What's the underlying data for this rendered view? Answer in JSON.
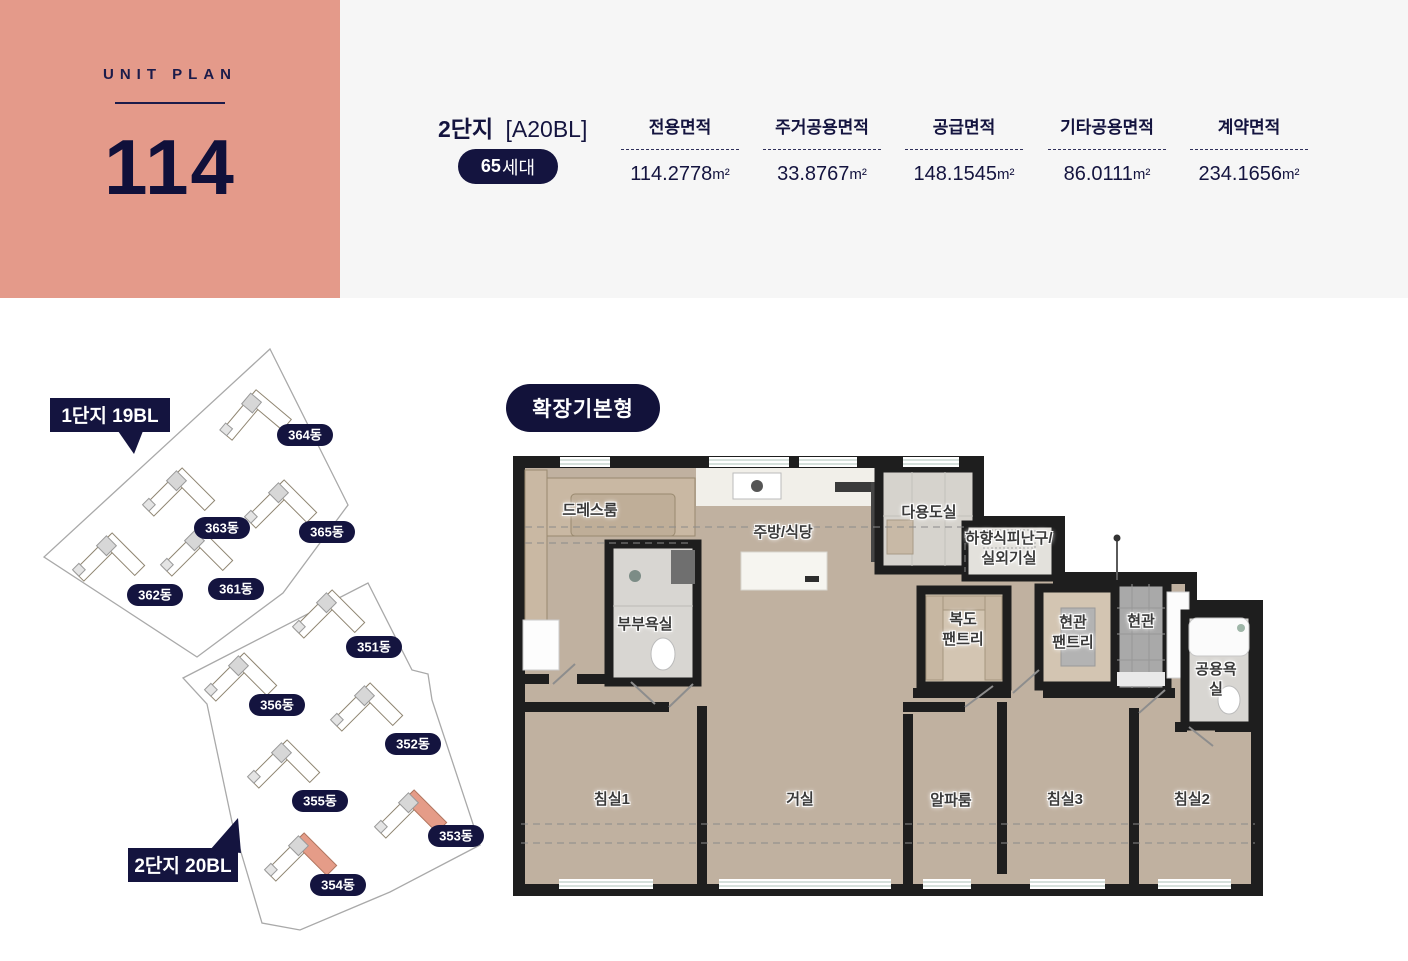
{
  "unit_plan": {
    "label": "UNIT PLAN",
    "number": "114"
  },
  "header": {
    "complex": "2단지",
    "block_code": "[A20BL]",
    "households_count": "65",
    "households_unit": "세대",
    "areas": [
      {
        "label": "전용면적",
        "value": "114.2778",
        "unit": "m²"
      },
      {
        "label": "주거공용면적",
        "value": "33.8767",
        "unit": "m²"
      },
      {
        "label": "공급면적",
        "value": "148.1545",
        "unit": "m²"
      },
      {
        "label": "기타공용면적",
        "value": "86.0111",
        "unit": "m²"
      },
      {
        "label": "계약면적",
        "value": "234.1656",
        "unit": "m²"
      }
    ]
  },
  "site_plan": {
    "district1_label": "1단지 19BL",
    "district2_label": "2단지 20BL",
    "buildings": [
      {
        "label": "364동"
      },
      {
        "label": "363동"
      },
      {
        "label": "365동"
      },
      {
        "label": "362동"
      },
      {
        "label": "361동"
      },
      {
        "label": "351동"
      },
      {
        "label": "356동"
      },
      {
        "label": "352동"
      },
      {
        "label": "355동"
      },
      {
        "label": "353동"
      },
      {
        "label": "354동"
      }
    ]
  },
  "floor_plan": {
    "type_label": "확장기본형",
    "rooms": [
      {
        "label": "드레스룸"
      },
      {
        "label": "주방/식당"
      },
      {
        "label": "다용도실"
      },
      {
        "label": "하향식피난구/\n실외기실"
      },
      {
        "label": "부부욕실"
      },
      {
        "label": "복도\n팬트리"
      },
      {
        "label": "현관\n팬트리"
      },
      {
        "label": "현관"
      },
      {
        "label": "공용욕실"
      },
      {
        "label": "침실1"
      },
      {
        "label": "거실"
      },
      {
        "label": "알파룸"
      },
      {
        "label": "침실3"
      },
      {
        "label": "침실2"
      }
    ]
  },
  "colors": {
    "accent_salmon": "#E49A8A",
    "navy": "#14143F",
    "header_bg": "#F6F6F6",
    "wall": "#1E1E1E",
    "wood_floor": "#C0B1A0"
  }
}
